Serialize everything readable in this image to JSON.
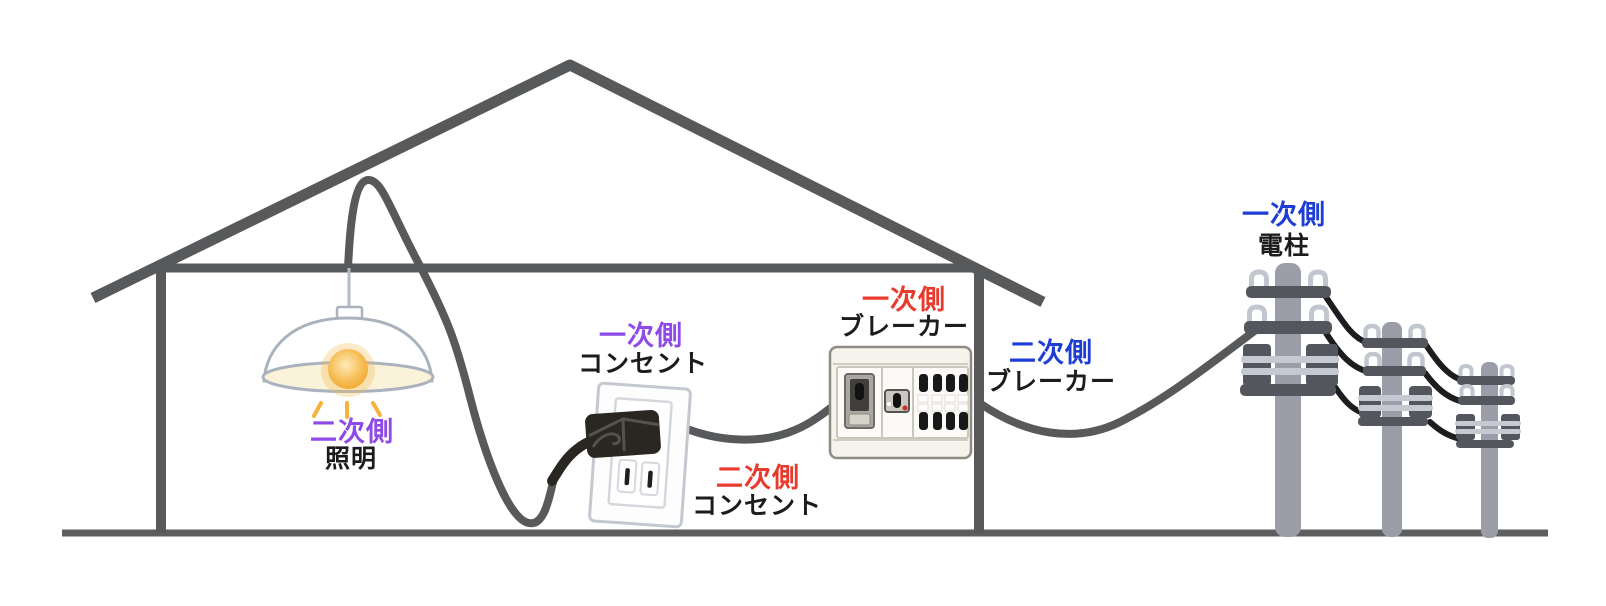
{
  "figure": {
    "title_hint": "house wiring primary/secondary sides illustration",
    "background": "#ffffff",
    "outline_color": "#58595a",
    "ground_color": "#5e5e5e",
    "cable_color": "#1d1d20",
    "cord_color": "#2a2723",
    "text_color": "#1c1c1c",
    "pole_color": "#9b9ea8",
    "crossarm_color": "#54565d",
    "band_color": "#c5c9d1",
    "insulator_color": "#c2c7cf",
    "lamp_rim_color": "#faf3da",
    "bulb_color": "#f0a326",
    "breaker_body_color": "#f6f3ec"
  },
  "labels": {
    "lamp_side": {
      "text": "二次側",
      "color": "#8d49e9"
    },
    "lamp_name": {
      "text": "照明"
    },
    "outlet_side_primary": {
      "text": "一次側",
      "color": "#8d49e9"
    },
    "outlet_name_primary": {
      "text": "コンセント"
    },
    "outlet_side_secondary": {
      "text": "二次側",
      "color": "#e93b2d"
    },
    "outlet_name_secondary": {
      "text": "コンセント"
    },
    "breaker_side_primary": {
      "text": "一次側",
      "color": "#e93b2d"
    },
    "breaker_name_primary": {
      "text": "ブレーカー"
    },
    "breaker_side_secondary": {
      "text": "二次側",
      "color": "#1d3dd6"
    },
    "breaker_name_secondary": {
      "text": "ブレーカー"
    },
    "pole_side": {
      "text": "一次側",
      "color": "#1d3dd6"
    },
    "pole_name": {
      "text": "電柱"
    }
  }
}
